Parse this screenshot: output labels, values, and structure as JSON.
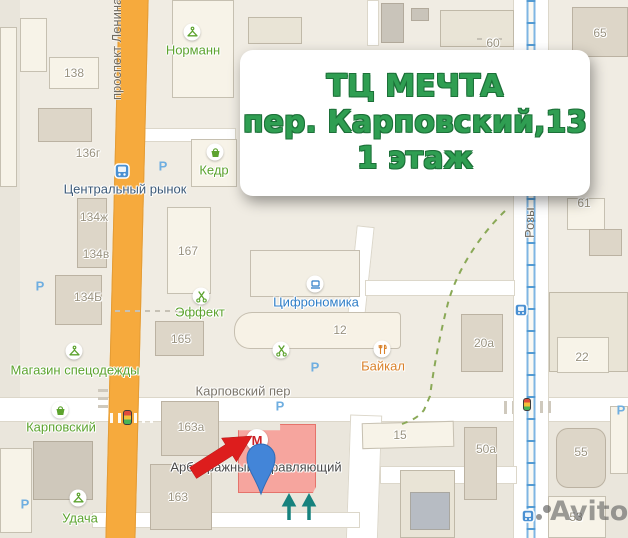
{
  "callout": {
    "line1": "ТЦ МЕЧТА",
    "line2": "пер. Карповский,13",
    "line3": "1 этаж",
    "text_color": "#2f9e52"
  },
  "map": {
    "streets": {
      "lenina": "проспект Ленина",
      "karpovsky": "Карповский пер",
      "rozy": "Розы"
    },
    "station": {
      "name": "Центральный рынок"
    },
    "buildings": [
      {
        "label": "138"
      },
      {
        "label": "136г"
      },
      {
        "label": "134ж"
      },
      {
        "label": "134в"
      },
      {
        "label": "134Б"
      },
      {
        "label": "167"
      },
      {
        "label": "165"
      },
      {
        "label": "12"
      },
      {
        "label": "163а"
      },
      {
        "label": "163"
      },
      {
        "label": "15"
      },
      {
        "label": "50а"
      },
      {
        "label": "55"
      },
      {
        "label": "53"
      },
      {
        "label": "22"
      },
      {
        "label": "20а"
      },
      {
        "label": "61"
      },
      {
        "label": "60"
      },
      {
        "label": "65"
      }
    ],
    "places": [
      {
        "name": "Норманн",
        "icon": "hanger"
      },
      {
        "name": "Кедр",
        "icon": "basket"
      },
      {
        "name": "Эффект",
        "icon": "scissors"
      },
      {
        "name": "Магазин спецодежды",
        "icon": "hanger"
      },
      {
        "name": "Карповский",
        "icon": "basket"
      },
      {
        "name": "Удача",
        "icon": "hanger"
      },
      {
        "name": "Цифрономика",
        "icon": "laptop"
      },
      {
        "name": "Байкал",
        "icon": "restaurant"
      },
      {
        "name": "Арбитражный управляющий",
        "icon": "none"
      }
    ],
    "parking_label": "P",
    "logo_letter": "М",
    "colors": {
      "road_orange": "#f6aa3d",
      "highlight_building_pink": "#f6a59e",
      "transit_line_blue": "#7fb6e3",
      "pin_blue": "#4385d8",
      "arrow_red": "#dd1d1d",
      "entrance_arrow_teal": "#17827d",
      "poi_green": "#5da32f"
    }
  },
  "watermark": {
    "text": "Avito"
  }
}
